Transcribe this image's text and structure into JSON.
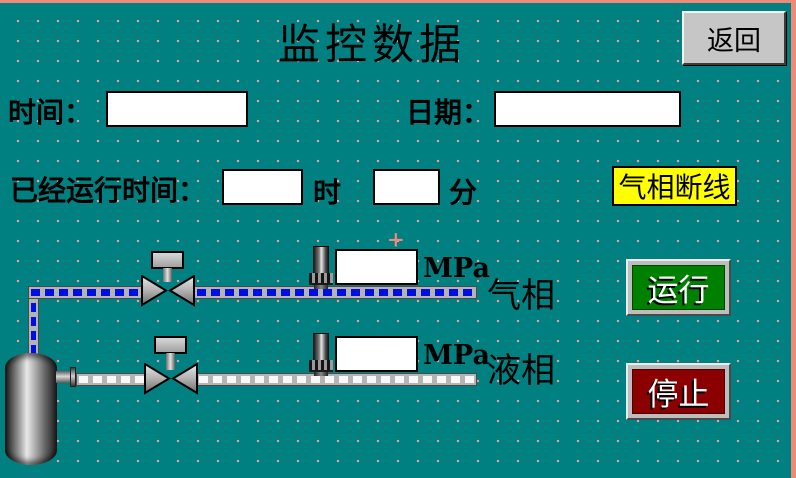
{
  "header": {
    "title": "监控数据",
    "back_label": "返回"
  },
  "datetime": {
    "time_label": "时间：",
    "time_value": "",
    "date_label": "日期：",
    "date_value": ""
  },
  "runtime": {
    "label": "已经运行时间：",
    "hours_value": "",
    "hours_unit": "时",
    "minutes_value": "",
    "minutes_unit": "分"
  },
  "alarm": {
    "text": "气相断线",
    "bg_color": "#ffff00"
  },
  "gas_line": {
    "label": "气相",
    "pressure_value": "",
    "unit": "MPa",
    "flow_dash_color": "#000fe0"
  },
  "liquid_line": {
    "label": "液相",
    "pressure_value": "",
    "unit": "MPa",
    "flow_dash_color": "#ffffff"
  },
  "controls": {
    "run_label": "运行",
    "run_color": "#008000",
    "stop_label": "停止",
    "stop_color": "#8b0000"
  },
  "cursor_marker": "+",
  "colors": {
    "background": "#008080",
    "grid_dot": "#f4a0a0",
    "frame_edge": "#f08a78",
    "button_face": "#c6c6c6",
    "pipe_body": "#b4b4b4"
  }
}
